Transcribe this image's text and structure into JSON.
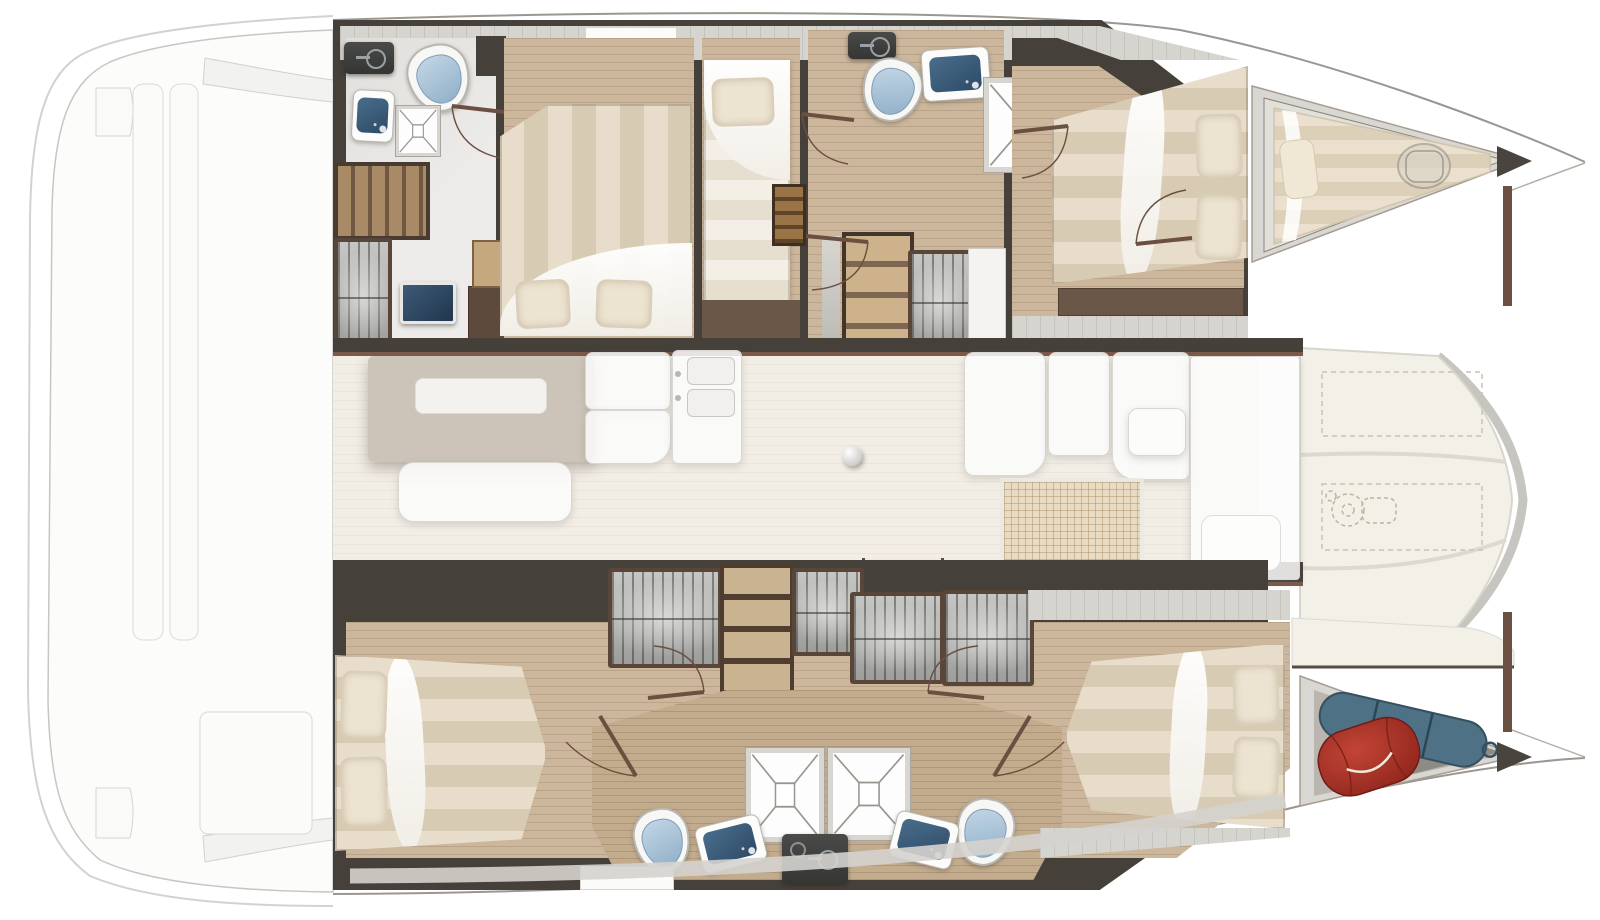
{
  "document": {
    "title": "Catamaran interior layout floor plan",
    "type": "boat-floor-plan",
    "orientation": "bow-right, stern-left, top-down view",
    "visible_text": []
  },
  "palette": {
    "background": "#ffffff",
    "wall_dark": "#46403a",
    "wall_accent_brown": "#7b5a49",
    "wood_floor": "#ccb79c",
    "tile_floor": "#edecea",
    "saloon_floor": "#f2eee6",
    "deck_band_gray": "#d6d4cf",
    "foredeck_cream": "#f3f0e8",
    "mattress_stripe_light": "#e7ddca",
    "mattress_stripe_dark": "#d8cbb4",
    "duvet_white": "#ffffff",
    "pillow": "#ece3d0",
    "toilet_lid_blue": "#8fafc8",
    "sink_basin_navy": "#2c4a66",
    "counter_dark": "#3a3a39",
    "berth_cushion": "#eae0cd",
    "red_bag": "#a82d22",
    "blue_bag": "#4e7186",
    "ghost_outline": "#d9d7d2"
  },
  "areas": {
    "aft_cockpit": {
      "label": "aft cockpit and swim platforms (ghosted)",
      "items": [
        "bench-cushion",
        "cockpit-bench",
        "seat-panels",
        "cockpit-table"
      ]
    },
    "port_hull": {
      "aft_bathroom": {
        "label": "port aft bathroom",
        "items": [
          "dark-vanity-counter",
          "faucet",
          "toilet",
          "shower-tray",
          "washbasin",
          "storage-steps",
          "ribbed-locker",
          "vanity-sink",
          "cabinet",
          "nightstand"
        ]
      },
      "aft_cabin": {
        "label": "port aft double cabin",
        "items": [
          "double-bed",
          "pillow",
          "pillow",
          "duvet"
        ]
      },
      "mid_cabin": {
        "label": "port single-berth cabin",
        "items": [
          "single-bed",
          "pillow",
          "companionway-ladder"
        ]
      },
      "mid_bathroom": {
        "label": "port forward bathroom",
        "items": [
          "dark-vanity-counter",
          "faucet",
          "toilet",
          "washbasin",
          "shower-cubicle"
        ]
      },
      "companionway": {
        "label": "port companionway stairs",
        "items": [
          "stairs-down",
          "ribbed-locker"
        ]
      },
      "forward_cabin": {
        "label": "port forward double cabin",
        "items": [
          "double-bed",
          "pillow",
          "pillow",
          "shelf-bench"
        ]
      },
      "forepeak": {
        "label": "port forepeak berth",
        "items": [
          "berth-cushion",
          "pillow",
          "deck-hatch"
        ]
      }
    },
    "saloon": {
      "label": "saloon and galley (ghosted roof view)",
      "items": [
        "dinette-table",
        "table-skylight",
        "sofa",
        "galley-cabinet",
        "galley-cabinet",
        "double-sink-counter",
        "mast-foot-ball",
        "forward-cockpit-seats-ghost",
        "grid-mat",
        "forward-bench-ghost"
      ]
    },
    "starboard_hull": {
      "aft_cabin": {
        "label": "starboard aft double cabin",
        "items": [
          "double-bed",
          "pillow",
          "pillow",
          "ribbed-locker",
          "shelf-unit",
          "ribbed-locker"
        ]
      },
      "aft_bathroom": {
        "label": "starboard aft bathroom",
        "items": [
          "shower-cubicle",
          "toilet",
          "washbasin"
        ]
      },
      "forward_bathroom": {
        "label": "starboard forward bathroom",
        "items": [
          "shower-cubicle",
          "toilet",
          "washbasin"
        ]
      },
      "shared_counter": {
        "label": "central dark vanity counter",
        "items": [
          "dark-vanity-counter",
          "faucet"
        ]
      },
      "forward_cabin": {
        "label": "starboard forward double cabin",
        "items": [
          "double-bed",
          "pillow",
          "pillow"
        ]
      },
      "bow_locker": {
        "label": "starboard bow storage locker",
        "items": [
          "red-duffel-bag",
          "blue-sail-bag"
        ]
      }
    },
    "foredeck": {
      "label": "foredeck between hulls",
      "items": [
        "locker-hatch-dashed",
        "locker-hatch-dashed",
        "windlass"
      ]
    }
  }
}
